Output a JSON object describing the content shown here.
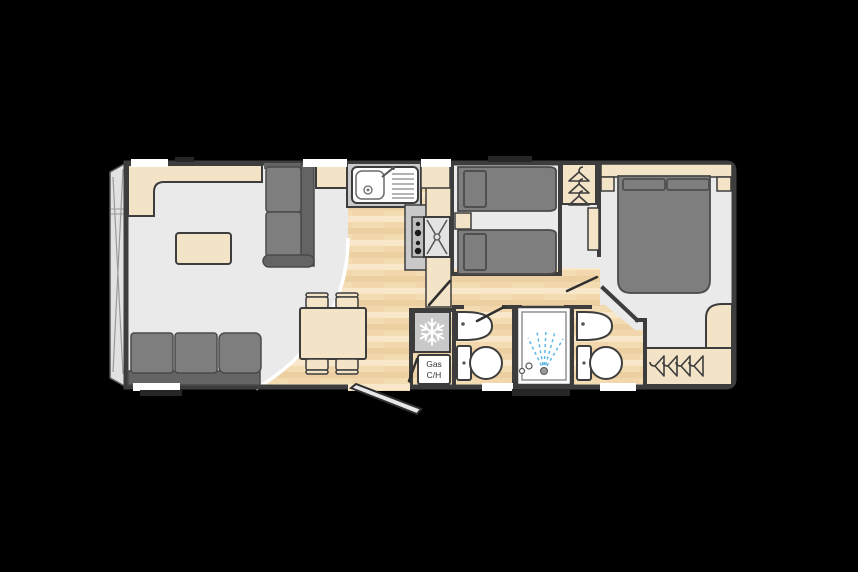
{
  "plan": {
    "name": "static-caravan-floorplan",
    "labels": {
      "gas_line1": "Gas",
      "gas_line2": "C/H"
    },
    "colors": {
      "background": "#000000",
      "wall": "#3d3d3d",
      "outline": "#4a4a4a",
      "floor": "#eaeaea",
      "wood_base": "#f3dcb2",
      "wood_light": "#f8e7c9",
      "wood_dark": "#ecd0a2",
      "wood_mid": "#f1d7ab",
      "cream": "#f4e4c7",
      "sofa": "#7e7e7e",
      "sofa_dark": "#646464",
      "worktop": "#c9c9c9",
      "fixture_white": "#ffffff",
      "spray_blue": "#5fb7e8",
      "front_glass": "#e2e2e2",
      "trim_dark": "#262626"
    },
    "icons": {
      "fridge": "snowflake-icon",
      "wardrobes": "clothes-hanger-icon",
      "cooker": "fan-oven-icon",
      "hob": "burner-dots-icon",
      "shower": "water-spray-icon",
      "sink": "sink-drainer-icon",
      "toilets": "toilet-icon",
      "basins": "washbasin-icon",
      "entrance": "open-door-swing"
    }
  }
}
